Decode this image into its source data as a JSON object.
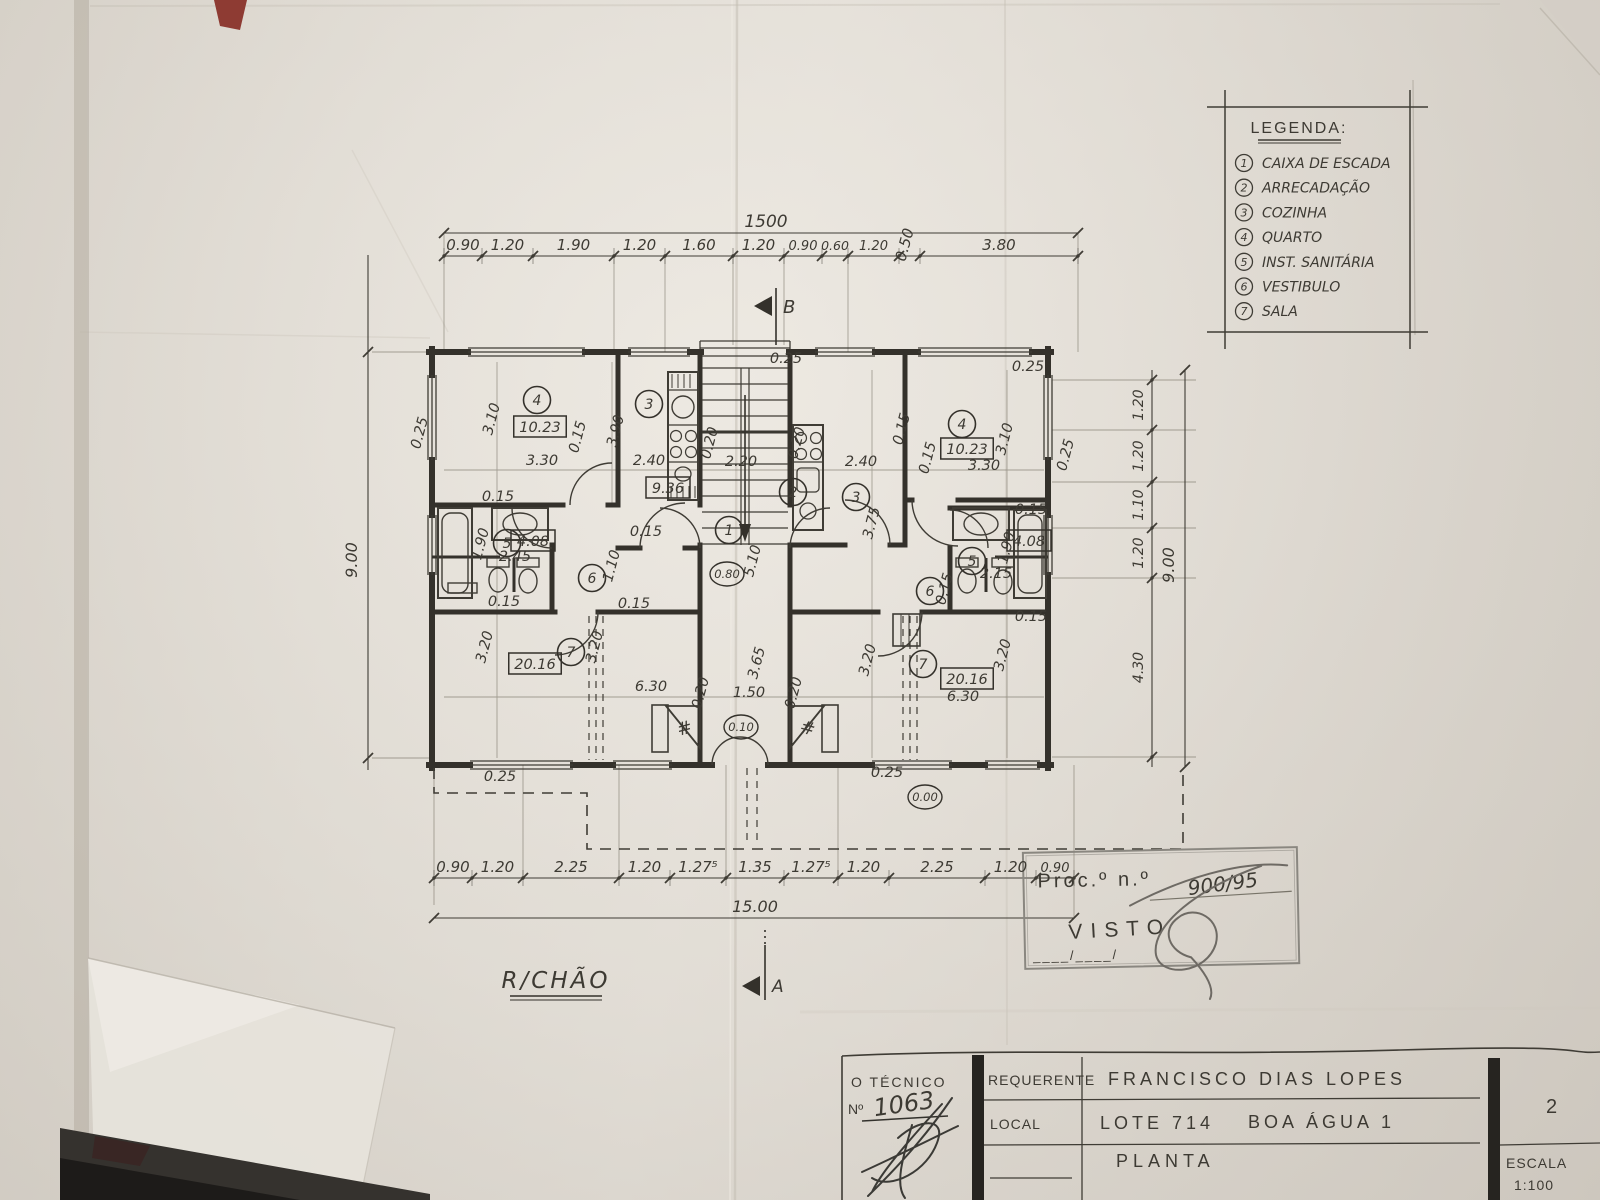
{
  "floor_label": "R/CHÃO",
  "markers": {
    "a": "A",
    "b": "B"
  },
  "legend": {
    "title": "LEGENDA:",
    "items": [
      {
        "num": "1",
        "label": "CAIXA DE ESCADA"
      },
      {
        "num": "2",
        "label": "ARRECADAÇÃO"
      },
      {
        "num": "3",
        "label": "COZINHA"
      },
      {
        "num": "4",
        "label": "QUARTO"
      },
      {
        "num": "5",
        "label": "INST. SANITÁRIA"
      },
      {
        "num": "6",
        "label": "VESTIBULO"
      },
      {
        "num": "7",
        "label": "SALA"
      }
    ]
  },
  "dims": {
    "top": {
      "total": "1500",
      "segments": [
        "0.90",
        "1.20",
        "1.90",
        "1.20",
        "1.60",
        "1.20",
        "0.90",
        "0.60",
        "1.20",
        "0.50",
        "3.80"
      ]
    },
    "bottom": {
      "total": "15.00",
      "segments": [
        "0.90",
        "1.20",
        "2.25",
        "1.20",
        "1.27⁵",
        "1.35",
        "1.27⁵",
        "1.20",
        "2.25",
        "1.20",
        "0.90"
      ]
    },
    "left": {
      "total": "9.00"
    },
    "right": {
      "total": "9.00",
      "segments": [
        "1.20",
        "1.20",
        "1.10",
        "1.20",
        "4.30"
      ]
    }
  },
  "plan": {
    "labels": [
      {
        "t": "0.25",
        "x": 424,
        "y": 434,
        "r": -75
      },
      {
        "t": "3.10",
        "x": 496,
        "y": 420,
        "r": -75
      },
      {
        "t": "0.15",
        "x": 582,
        "y": 438,
        "r": -75
      },
      {
        "t": "3.30",
        "x": 542,
        "y": 465,
        "r": 0
      },
      {
        "t": "3.90",
        "x": 620,
        "y": 432,
        "r": -75
      },
      {
        "t": "2.40",
        "x": 649,
        "y": 465,
        "r": 0
      },
      {
        "t": "0.20",
        "x": 714,
        "y": 444,
        "r": -75
      },
      {
        "t": "0.25",
        "x": 786,
        "y": 363,
        "r": 0
      },
      {
        "t": "0.20",
        "x": 801,
        "y": 444,
        "r": -75
      },
      {
        "t": "2.20",
        "x": 741,
        "y": 466,
        "r": 0
      },
      {
        "t": "2.40",
        "x": 861,
        "y": 466,
        "r": 0
      },
      {
        "t": "3.75",
        "x": 876,
        "y": 524,
        "r": -75
      },
      {
        "t": "0.15",
        "x": 932,
        "y": 459,
        "r": -75
      },
      {
        "t": "3.10",
        "x": 1009,
        "y": 440,
        "r": -75
      },
      {
        "t": "3.30",
        "x": 984,
        "y": 470,
        "r": 0
      },
      {
        "t": "0.25",
        "x": 1070,
        "y": 456,
        "r": -75
      },
      {
        "t": "0.25",
        "x": 1028,
        "y": 371,
        "r": 0
      },
      {
        "t": "0.15",
        "x": 498,
        "y": 501,
        "r": 0
      },
      {
        "t": "1.90",
        "x": 485,
        "y": 545,
        "r": -75
      },
      {
        "t": "2.45",
        "x": 515,
        "y": 561,
        "r": 0
      },
      {
        "t": "0.15",
        "x": 646,
        "y": 536,
        "r": 0
      },
      {
        "t": "1.10",
        "x": 616,
        "y": 567,
        "r": -75
      },
      {
        "t": "5.10",
        "x": 757,
        "y": 562,
        "r": -75
      },
      {
        "t": "0.15",
        "x": 504,
        "y": 606,
        "r": 0
      },
      {
        "t": "0.15",
        "x": 634,
        "y": 608,
        "r": 0
      },
      {
        "t": "3.20",
        "x": 489,
        "y": 648,
        "r": -75
      },
      {
        "t": "3.20",
        "x": 599,
        "y": 648,
        "r": -75
      },
      {
        "t": "6.30",
        "x": 651,
        "y": 691,
        "r": 0
      },
      {
        "t": "0.20",
        "x": 705,
        "y": 694,
        "r": -75
      },
      {
        "t": "1.50",
        "x": 749,
        "y": 697,
        "r": 0
      },
      {
        "t": "3.65",
        "x": 761,
        "y": 664,
        "r": -75
      },
      {
        "t": "0.20",
        "x": 798,
        "y": 694,
        "r": -75
      },
      {
        "t": "3.20",
        "x": 872,
        "y": 661,
        "r": -75
      },
      {
        "t": "3.20",
        "x": 1007,
        "y": 656,
        "r": -75
      },
      {
        "t": "6.30",
        "x": 963,
        "y": 701,
        "r": 0
      },
      {
        "t": "0.25",
        "x": 500,
        "y": 781,
        "r": 0
      },
      {
        "t": "0.25",
        "x": 887,
        "y": 777,
        "r": 0
      },
      {
        "t": "1.90",
        "x": 1011,
        "y": 549,
        "r": -75
      },
      {
        "t": "2.15",
        "x": 996,
        "y": 578,
        "r": 0
      },
      {
        "t": "0.15",
        "x": 949,
        "y": 590,
        "r": -75
      },
      {
        "t": "0.15",
        "x": 1031,
        "y": 514,
        "r": 0
      },
      {
        "t": "0.15",
        "x": 1031,
        "y": 621,
        "r": 0
      },
      {
        "t": "0.15",
        "x": 906,
        "y": 430,
        "r": -75
      }
    ],
    "rooms": [
      {
        "n": "4",
        "x": 537,
        "y": 400
      },
      {
        "n": "3",
        "x": 649,
        "y": 404
      },
      {
        "n": "5",
        "x": 507,
        "y": 543
      },
      {
        "n": "6",
        "x": 592,
        "y": 578
      },
      {
        "n": "7",
        "x": 571,
        "y": 652
      },
      {
        "n": "1",
        "x": 729,
        "y": 530
      },
      {
        "n": "2",
        "x": 793,
        "y": 492
      },
      {
        "n": "3",
        "x": 856,
        "y": 497
      },
      {
        "n": "4",
        "x": 962,
        "y": 424
      },
      {
        "n": "5",
        "x": 972,
        "y": 561
      },
      {
        "n": "6",
        "x": 930,
        "y": 591
      },
      {
        "n": "7",
        "x": 923,
        "y": 664
      }
    ],
    "areas": [
      {
        "v": "10.23",
        "x": 540,
        "y": 427
      },
      {
        "v": "9.36",
        "x": 668,
        "y": 488
      },
      {
        "v": "4.08",
        "x": 533,
        "y": 541
      },
      {
        "v": "20.16",
        "x": 535,
        "y": 664
      },
      {
        "v": "10.23",
        "x": 967,
        "y": 449
      },
      {
        "v": "4.08",
        "x": 1029,
        "y": 541
      },
      {
        "v": "20.16",
        "x": 967,
        "y": 679
      }
    ],
    "levels": [
      {
        "v": "0.80",
        "x": 727,
        "y": 574
      },
      {
        "v": "0.10",
        "x": 741,
        "y": 727
      },
      {
        "v": "0.00",
        "x": 925,
        "y": 797
      }
    ],
    "hatch_marks": [
      {
        "t": "#",
        "x": 686,
        "y": 734,
        "r": -15
      },
      {
        "t": "#",
        "x": 806,
        "y": 734,
        "r": 15
      }
    ]
  },
  "stamp": {
    "proc": "Proc.º n.º",
    "proc_value": "900/95",
    "visto": "VISTO",
    "date_line": "____/____/"
  },
  "title_block": {
    "tecnico": "O TÉCNICO",
    "num_label": "Nº",
    "num_value": "1063",
    "requerente_label": "REQUERENTE",
    "requerente": "FRANCISCO DIAS LOPES",
    "local_label": "LOCAL",
    "local_lote": "LOTE 714",
    "local_name": "BOA ÁGUA 1",
    "drawing": "PLANTA",
    "sheet": "2",
    "escala_label": "ESCALA",
    "escala": "1:100"
  }
}
